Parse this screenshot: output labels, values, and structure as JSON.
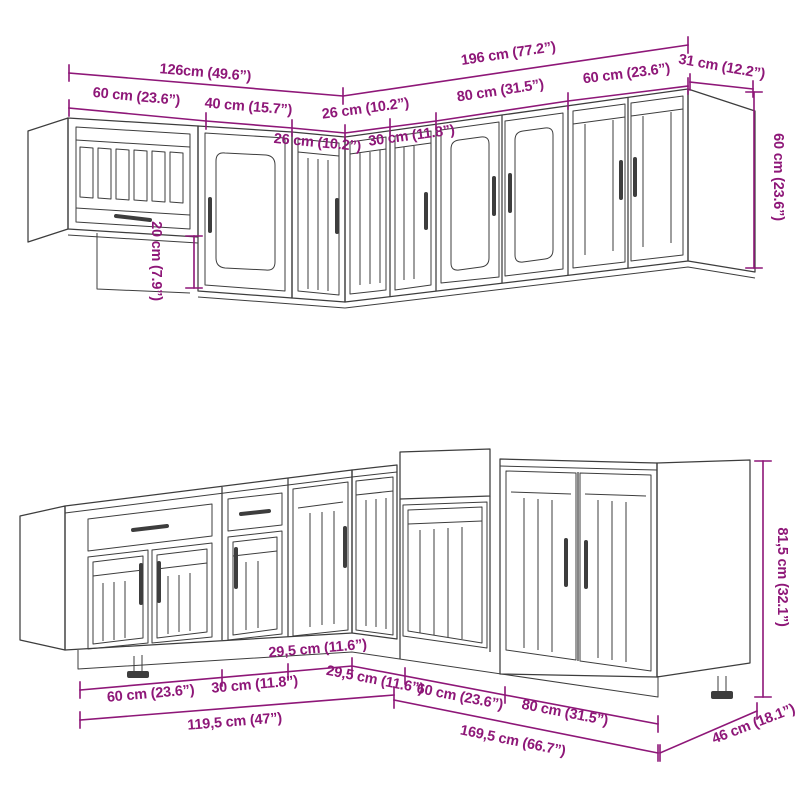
{
  "figure": {
    "type": "kitchen-cabinet-set-dimension-diagram",
    "rows": [
      "upper wall cabinets",
      "base cabinets"
    ],
    "units": "cm (inches)"
  },
  "colors": {
    "dimension_accent": "#8e1778",
    "line_art": "#3d3d3d",
    "background": "#ffffff"
  },
  "dimensions": {
    "upper": {
      "run_left_total": "126cm (49.6”)",
      "run_right_total": "196 cm (77.2”)",
      "side_depth": "31 cm (12.2”)",
      "cabinet_height": "60 cm (23.6”)",
      "height_step": "20 cm (7.9”)",
      "widths_left": [
        "60 cm (23.6”)",
        "40 cm (15.7”)",
        "26 cm (10.2”)"
      ],
      "widths_right": [
        "26 cm (10.2”)",
        "30 cm (11.8”)",
        "80 cm (31.5”)",
        "60 cm (23.6”)"
      ]
    },
    "base": {
      "run_left_total": "119,5 cm (47”)",
      "run_right_total": "169,5 cm (66.7”)",
      "side_depth": "46 cm (18.1”)",
      "cabinet_height": "81,5 cm (32.1”)",
      "widths_left": [
        "60 cm (23.6”)",
        "30 cm (11.8”)",
        "29,5 cm (11.6”)"
      ],
      "widths_right": [
        "29,5 cm (11.6”)",
        "60 cm (23.6”)",
        "80 cm (31.5”)"
      ]
    }
  }
}
